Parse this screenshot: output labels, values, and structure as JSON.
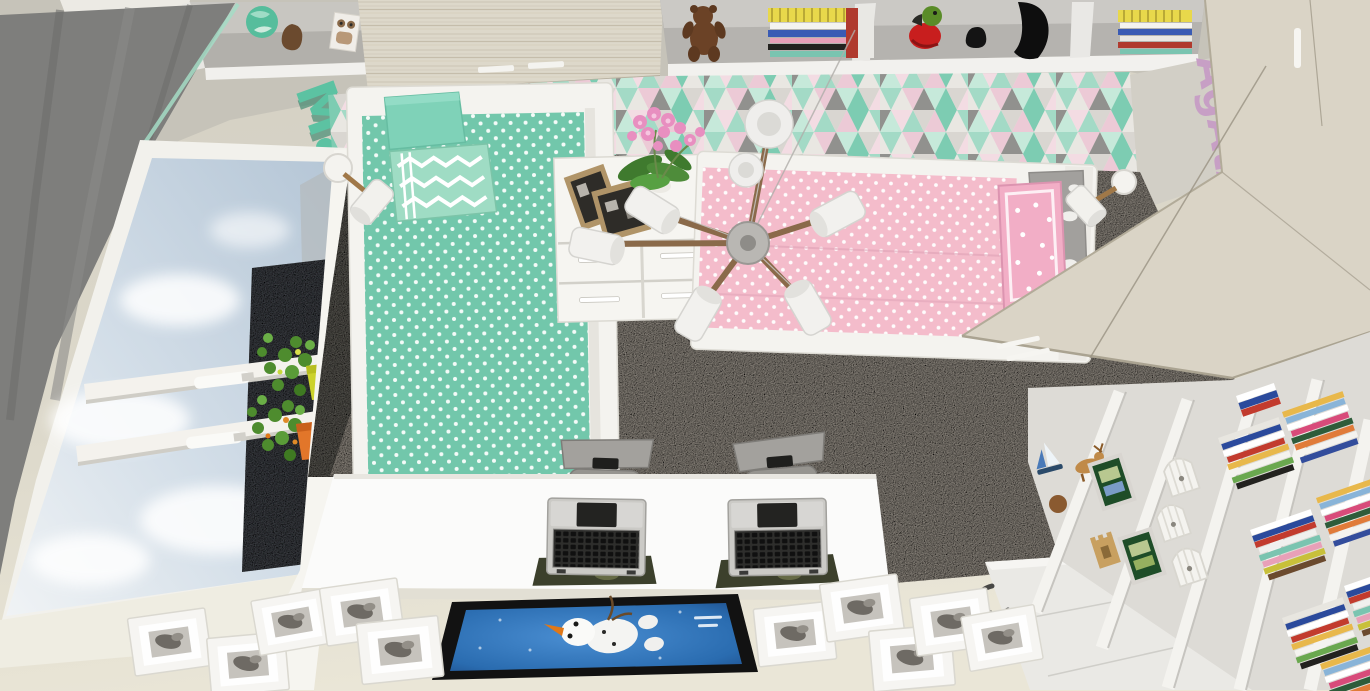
{
  "scene": {
    "kind": "3d-room-render-top-view",
    "room": "children's bedroom with two beds, desk and wardrobe (top-down cutaway 3D render)",
    "decals": {
      "left_wall_name": "Maja",
      "right_wall_name": "AgAtA"
    },
    "palette": {
      "wall": "#c6c3b9",
      "curtain": "#7e7e7c",
      "mint": "#72c7ab",
      "mint_light": "#a3dac6",
      "pink": "#f4bccb",
      "carpet": "#8b857d",
      "dark_rug": "#56544f",
      "wood": "#dad4c6",
      "desk": "#fbfbfa",
      "sky": "#c3d2e0",
      "floor_outside": "#e2ded0",
      "poster_blue": "#2a6cb0",
      "decal_left": "#5cc2a2",
      "decal_right": "#c79fc5"
    },
    "objects": {
      "beds": [
        "mint polka-dot bed",
        "pink polka-dot bed"
      ],
      "pillows": [
        "solid mint pillow",
        "mint chevron pillow",
        "pink dotted pillow",
        "grey cloud pillow"
      ],
      "furniture": [
        "white dresser with photo frames and orchid",
        "long white desk",
        "two grey office chairs",
        "light-wood wardrobe",
        "white bookshelf with colourful books",
        "white wall shelves with toys"
      ],
      "electronics": [
        "two open laptops with camo mouse pads"
      ],
      "decor": [
        "triangle-pattern wallpaper",
        "multi-arm wood chandelier with white shades",
        "two white wall lamps",
        "teddy bear",
        "globe",
        "parrot toy",
        "black vases",
        "stacked books",
        "sailboat toy",
        "deer figurine",
        "birdcage ornaments",
        "potted plants on window sill",
        "Olaf poster lying on floor",
        "white photo frames lying on floor",
        "white door laid flat"
      ],
      "window": "large window with cloudy sky and dark building outside"
    }
  }
}
